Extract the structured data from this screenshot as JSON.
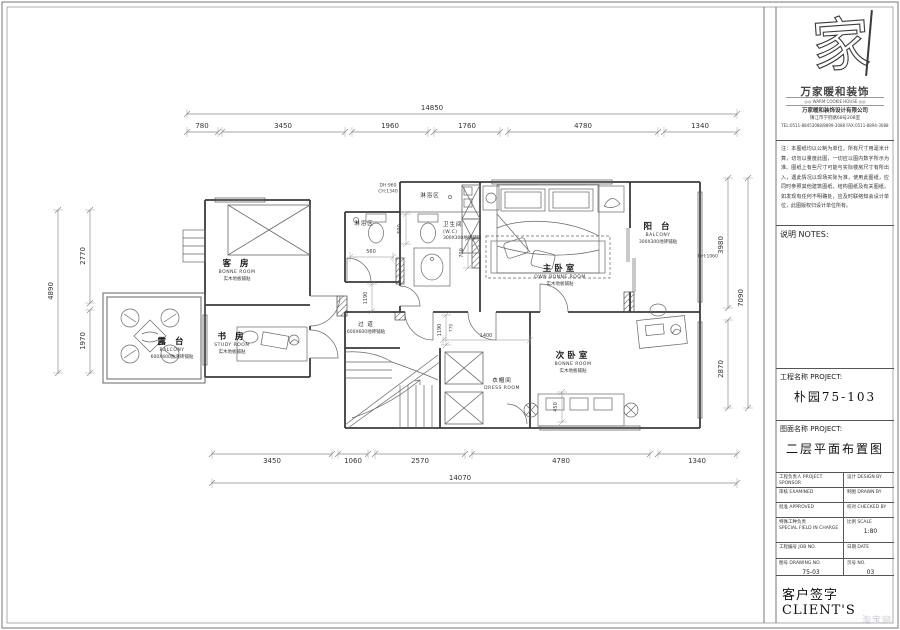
{
  "title_block": {
    "logo": {
      "glyph": "家",
      "brand": "万家暖和装饰",
      "brand_en": "◎◎ WARM COOKIE HOUSE ◎◎",
      "company": "万家暖和装饰设计有限公司",
      "address": "镇江市学府路68号208室",
      "phone": "TEL:0511-88453088/8899-3088  FAX:0511-8894-3088"
    },
    "notes_text": "注：本图纸均以公制为单位，所有尺寸用毫米计算，切勿以量度此图，一切应以图内数字所示为准。图纸上有些尺寸可能与实际楼房尺寸有所出入，遇此情况以现场实际为准，使用此图纸，应同时参照其他建筑图纸、结构图纸及有关图纸。如发现有任何不明确处，应及时联络知会设计单位，此图版权归设计单位所有。",
    "notes_label": "说明  NOTES:",
    "project_label": "工程名称 PROJECT:",
    "project_value": "朴园75-103",
    "drawing_label": "图面名称 PROJECT:",
    "drawing_value": "二层平面布置图",
    "rows": [
      {
        "left": "工程负责人 PROJECT SPONSOR",
        "right": "设计 DESIGN BY"
      },
      {
        "left": "审核 EXAMINED",
        "right": "制图 DRAWN BY"
      },
      {
        "left": "批准 APPROVED",
        "right": "校对 CHECKED BY"
      },
      {
        "left": "特殊工种负责",
        "left2": "SPECIAL FIELD IN CHARGE",
        "right": "比例 SCALE",
        "right2": "1:80"
      },
      {
        "left": "工程编号 JOB NO.",
        "right": "日期 DATE"
      },
      {
        "left": "图号 DRAWING NO.",
        "left2": "75-03",
        "right": "页号 NO.",
        "right2": "03"
      }
    ],
    "client_label": "客户签字 CLIENT'S"
  },
  "plan": {
    "dims_top": {
      "overall": "14850",
      "segs": [
        "780",
        "3450",
        "1960",
        "1760",
        "4780",
        "1340"
      ]
    },
    "dims_bottom": {
      "overall": "14070",
      "segs": [
        "3450",
        "1060",
        "2570",
        "4780",
        "1340"
      ]
    },
    "dims_left": {
      "overall": "4890",
      "segs": [
        "2770",
        "1970"
      ]
    },
    "dims_right": {
      "overall": "7090",
      "segs": [
        "3980",
        "2870"
      ]
    },
    "inner_dims": {
      "d560": "560",
      "d590": "590",
      "d700": "700",
      "d1190a": "1190",
      "d1190b": "1190",
      "d770": "770",
      "d1400": "1400",
      "d450": "450",
      "dh960": "DH:960",
      "ch1340": "CH:1340",
      "dh1060": "DH:1060"
    },
    "rooms": {
      "guest": {
        "name": "客 房",
        "en": "BONNE ROOM",
        "sub": "实木地板铺贴"
      },
      "study": {
        "name": "书 房",
        "en": "STUDY ROOM",
        "sub": "实木地板铺贴"
      },
      "terrace": {
        "name": "露 台",
        "en": "BALCONY",
        "sub": "600X600防滑砖铺贴"
      },
      "master": {
        "name": "主卧室",
        "en": "OWN BONNE ROOM",
        "sub": "实木地板铺贴"
      },
      "balcony": {
        "name": "阳 台",
        "en": "BALCONY",
        "sub": "300X300地砖铺贴"
      },
      "second": {
        "name": "次卧室",
        "en": "BONNE ROOM",
        "sub": "实木地板铺贴"
      },
      "corridor": {
        "name": "过 道",
        "sub": "600X600地砖铺贴"
      },
      "wc": {
        "name": "卫生间",
        "en": "(W.C)",
        "sub": "300X300地砖铺贴"
      },
      "cloak": {
        "name": "衣帽间",
        "en": "DRESS ROOM"
      },
      "shower1": {
        "name": "淋浴区"
      },
      "shower2": {
        "name": "淋浴区"
      }
    },
    "watermark": "淘宝网"
  }
}
